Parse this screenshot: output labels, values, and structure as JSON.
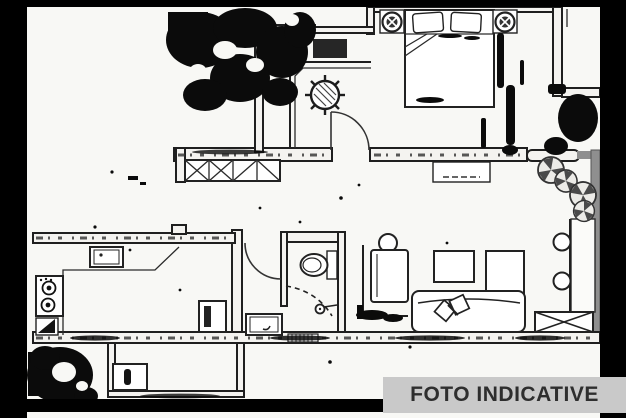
{
  "page": {
    "type": "floor-plan-scan",
    "description": "Black-and-white apartment floor plan, heavily degraded scan with black noise blobs and a black border frame"
  },
  "banner": {
    "label": "FOTO INDICATIVE",
    "bg_color": "#c9c9c9",
    "text_color": "#2e2e2e"
  },
  "colors": {
    "background": "#f8f8f5",
    "ink": "#1f1f1f",
    "frame_black": "#000000",
    "wall_gray": "#8f8f8f",
    "plant_petal_gray": "#4a4a4a"
  },
  "plan": {
    "rooms": [
      {
        "name": "bedroom"
      },
      {
        "name": "dressing-corridor"
      },
      {
        "name": "hallway"
      },
      {
        "name": "bathroom"
      },
      {
        "name": "kitchen"
      },
      {
        "name": "living-room"
      },
      {
        "name": "terrace"
      },
      {
        "name": "balcony"
      }
    ],
    "symbols": [
      "double-bed-icon",
      "pillow-icon",
      "nightstand-lamp-icon",
      "wardrobe-x-hatch-icon",
      "plant-icon",
      "door-swing-arc-icon",
      "toilet-icon",
      "shower-head-icon",
      "sink-icon",
      "stove-burners-icon",
      "corner-cabinet-icon",
      "fridge-icon",
      "armchair-icon",
      "coffee-table-icon",
      "tv-cabinet-icon",
      "sofa-with-pillows-icon",
      "console-table-icon",
      "round-chair-icon",
      "storage-x-box-icon",
      "terrace-plant-pinwheel-icon",
      "window-pill-icon",
      "shower-threshold-hatch-icon"
    ]
  }
}
